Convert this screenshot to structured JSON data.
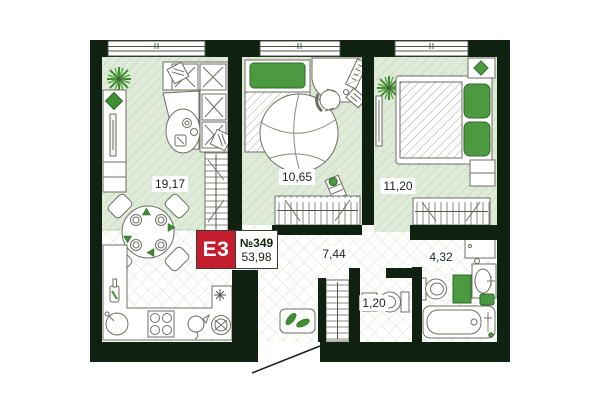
{
  "floor_plan": {
    "badge": {
      "layout_code": "E3",
      "unit_number": "№349",
      "total_area": "53,98"
    },
    "rooms": {
      "living_kitchen": {
        "area": "19,17"
      },
      "bedroom_small": {
        "area": "10,65"
      },
      "bedroom_large": {
        "area": "11,20"
      },
      "hallway": {
        "area": "7,44"
      },
      "bathroom": {
        "area": "4,32"
      },
      "wc": {
        "area": "1,20"
      }
    },
    "colors": {
      "wall": "#0f2110",
      "room_floor_tint": "#dfead9",
      "accent_green": "#4c9a3f",
      "badge_red": "#c41e2e"
    }
  }
}
